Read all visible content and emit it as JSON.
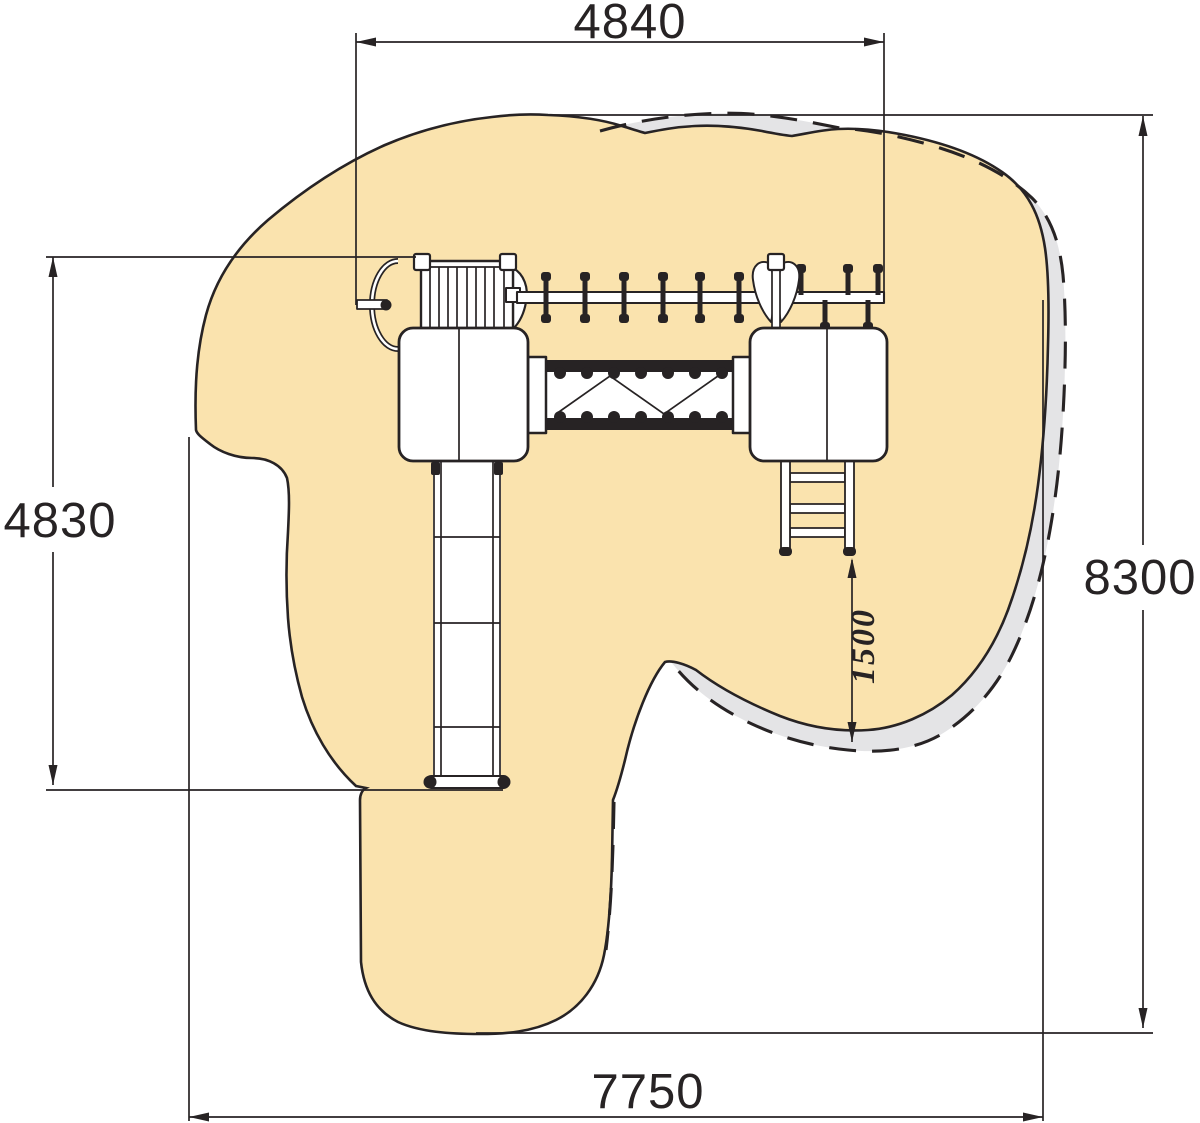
{
  "drawing": {
    "title": "playground-equipment-plan-view",
    "dimensions": {
      "top_width": "4840",
      "left_height": "4830",
      "right_height": "8300",
      "bottom_width": "7750",
      "inner_clearance": "1500"
    },
    "colors": {
      "sand": "#FAE3AE",
      "impact_zone": "#E4E4E6",
      "line": "#272324",
      "background": "#FFFFFF"
    }
  }
}
